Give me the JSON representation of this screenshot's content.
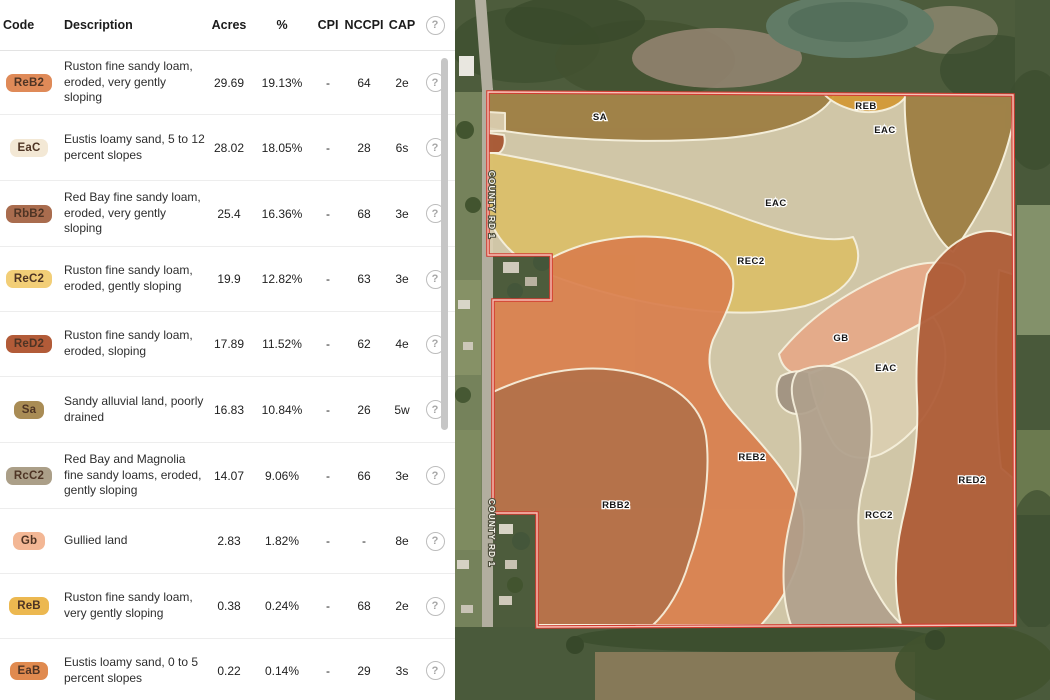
{
  "table": {
    "columns": [
      "Code",
      "Description",
      "Acres",
      "%",
      "CPI",
      "NCCPI",
      "CAP"
    ],
    "help_glyph": "?",
    "rows": [
      {
        "code": "ReB2",
        "badge_color": "#df8a58",
        "description": "Ruston fine sandy loam, eroded, very gently sloping",
        "acres": "29.69",
        "pct": "19.13%",
        "cpi": "-",
        "nccpi": "64",
        "cap": "2e"
      },
      {
        "code": "EaC",
        "badge_color": "#f3e8d5",
        "description": "Eustis loamy sand, 5 to 12 percent slopes",
        "acres": "28.02",
        "pct": "18.05%",
        "cpi": "-",
        "nccpi": "28",
        "cap": "6s"
      },
      {
        "code": "RbB2",
        "badge_color": "#a96c4e",
        "description": "Red Bay fine sandy loam, eroded, very gently sloping",
        "acres": "25.4",
        "pct": "16.36%",
        "cpi": "-",
        "nccpi": "68",
        "cap": "3e"
      },
      {
        "code": "ReC2",
        "badge_color": "#f2ce77",
        "description": "Ruston fine sandy loam, eroded, gently sloping",
        "acres": "19.9",
        "pct": "12.82%",
        "cpi": "-",
        "nccpi": "63",
        "cap": "3e"
      },
      {
        "code": "ReD2",
        "badge_color": "#b25b38",
        "description": "Ruston fine sandy loam, eroded, sloping",
        "acres": "17.89",
        "pct": "11.52%",
        "cpi": "-",
        "nccpi": "62",
        "cap": "4e"
      },
      {
        "code": "Sa",
        "badge_color": "#a98c55",
        "description": "Sandy alluvial land, poorly drained",
        "acres": "16.83",
        "pct": "10.84%",
        "cpi": "-",
        "nccpi": "26",
        "cap": "5w"
      },
      {
        "code": "RcC2",
        "badge_color": "#ab9f88",
        "description": "Red Bay and Magnolia fine sandy loams, eroded, gently sloping",
        "acres": "14.07",
        "pct": "9.06%",
        "cpi": "-",
        "nccpi": "66",
        "cap": "3e"
      },
      {
        "code": "Gb",
        "badge_color": "#f3b795",
        "description": "Gullied land",
        "acres": "2.83",
        "pct": "1.82%",
        "cpi": "-",
        "nccpi": "-",
        "cap": "8e"
      },
      {
        "code": "ReB",
        "badge_color": "#ecb850",
        "description": "Ruston fine sandy loam, very gently sloping",
        "acres": "0.38",
        "pct": "0.24%",
        "cpi": "-",
        "nccpi": "68",
        "cap": "2e"
      },
      {
        "code": "EaB",
        "badge_color": "#e08a4f",
        "description": "Eustis loamy sand, 0 to 5 percent slopes",
        "acres": "0.22",
        "pct": "0.14%",
        "cpi": "-",
        "nccpi": "29",
        "cap": "3s"
      }
    ]
  },
  "map": {
    "road_label": "COUNTY RD 1",
    "road_label_positions": [
      {
        "x": 34,
        "y": 205
      },
      {
        "x": 34,
        "y": 533
      }
    ],
    "boundary_color": "#d23b30",
    "boundary_inner_color": "#f6c3b8",
    "zone_border_color": "#f7f1de",
    "zone_colors": {
      "sa": "#9c7c41",
      "eac": "#dbcfb1",
      "reb": "#d29733",
      "rec2": "#dbbf69",
      "gb": "#e6a988",
      "reb2": "#d97f4e",
      "rbb2": "#b3714a",
      "rcc2": "#b0a08c",
      "red2": "#ad5a35",
      "gold_strip": "#b98f4a",
      "gray_wedge": "#a09181",
      "eab": "#a6542f"
    },
    "labels": [
      {
        "text": "SA",
        "x": 145,
        "y": 120
      },
      {
        "text": "REB",
        "x": 411,
        "y": 109
      },
      {
        "text": "EAC",
        "x": 430,
        "y": 133
      },
      {
        "text": "EAC",
        "x": 321,
        "y": 206
      },
      {
        "text": "REC2",
        "x": 296,
        "y": 264
      },
      {
        "text": "GB",
        "x": 386,
        "y": 341
      },
      {
        "text": "EAC",
        "x": 431,
        "y": 371
      },
      {
        "text": "REB2",
        "x": 297,
        "y": 460
      },
      {
        "text": "RBB2",
        "x": 161,
        "y": 508
      },
      {
        "text": "RCC2",
        "x": 424,
        "y": 518
      },
      {
        "text": "RED2",
        "x": 517,
        "y": 483
      }
    ]
  }
}
